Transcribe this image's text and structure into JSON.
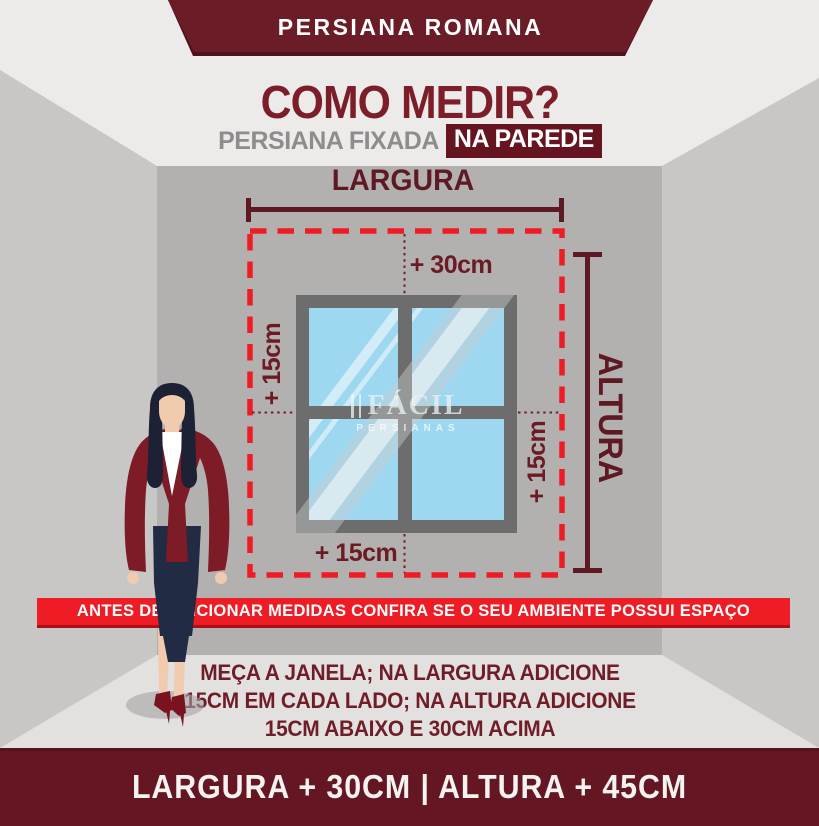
{
  "colors": {
    "maroon_banner": "#6a1c27",
    "maroon_text": "#7c1e2a",
    "maroon_deep": "#5e1a23",
    "highlight_box": "#661420",
    "alert_red": "#ee1c24",
    "footer_maroon": "#641722",
    "center_wall_gray": "#b3b1b0",
    "glass_blue": "#9ed7f0",
    "jacket_maroon": "#7d1b27"
  },
  "top_banner": {
    "label": "PERSIANA ROMANA"
  },
  "title": {
    "heading": "COMO MEDIR?",
    "subtitle_prefix": "PERSIANA FIXADA",
    "subtitle_highlight": "NA PAREDE"
  },
  "diagram": {
    "width_label": "LARGURA",
    "height_label": "ALTURA",
    "offset_top": "+ 30cm",
    "offset_left": "+ 15cm",
    "offset_right": "+ 15cm",
    "offset_bottom": "+ 15cm",
    "watermark_brand": "FÁCIL",
    "watermark_sub": "PERSIANAS"
  },
  "notice": {
    "text": "ANTES DE ADICIONAR MEDIDAS CONFIRA SE O SEU AMBIENTE POSSUI ESPAÇO"
  },
  "instructions": {
    "lines": [
      "MEÇA A JANELA; NA LARGURA ADICIONE",
      "15CM EM CADA LADO; NA ALTURA ADICIONE",
      "15CM ABAIXO E 30CM ACIMA"
    ]
  },
  "footer": {
    "formula": "LARGURA + 30CM | ALTURA + 45CM"
  }
}
